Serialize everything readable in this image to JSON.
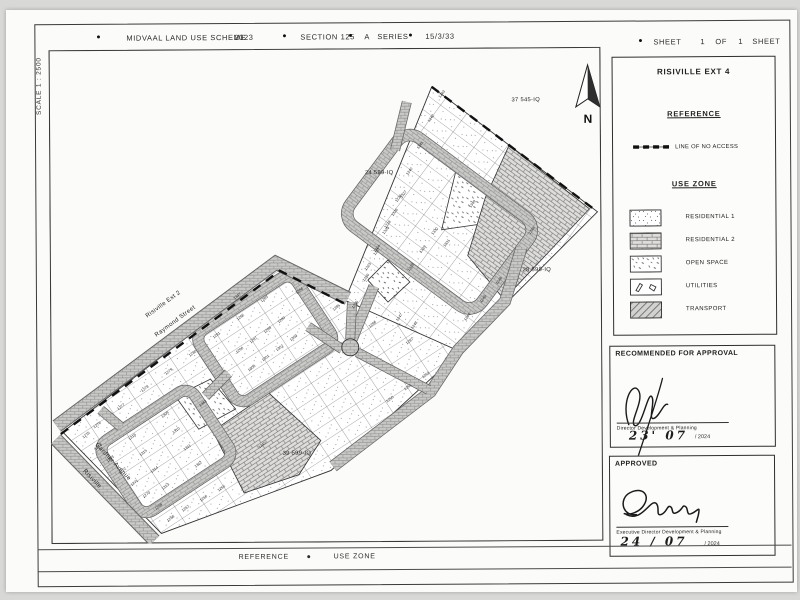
{
  "header": {
    "bullet": "●",
    "title": "MIDVAAL LAND USE SCHEME",
    "year": "2023",
    "section": "SECTION 125",
    "series_letter": "A",
    "series_word": "SERIES",
    "file_ref": "15/3/33",
    "sheet_word": "SHEET",
    "sheet_number": "1",
    "of_word": "OF",
    "sheet_total": "1",
    "sheet_word_2": "SHEET"
  },
  "scale_label": "SCALE 1 : 2500",
  "map": {
    "north_label": "N",
    "areas": {
      "north_west": "37 545-IQ",
      "west": "24 599-IQ",
      "east": "28 599-IQ",
      "south": "39 599-IQ"
    },
    "streets": {
      "adjacent_township": "Risiville Ext 2",
      "raymond": "Raymond Street",
      "gardner": "Gardner Avenue",
      "risiville": "Risiville"
    },
    "plots": [
      "1235",
      "1236",
      "1237",
      "1238",
      "1239",
      "1240",
      "1241",
      "1242",
      "1243",
      "1323",
      "1324",
      "1325",
      "1326",
      "1327",
      "1328",
      "1329",
      "1330",
      "1331",
      "1244",
      "1245",
      "1246",
      "1247",
      "1248",
      "1349",
      "1348",
      "1276",
      "1277",
      "1278",
      "1279",
      "1280",
      "1281",
      "1282",
      "1283",
      "1275",
      "1274",
      "1273",
      "1272",
      "1271",
      "1270",
      "1269",
      "1268",
      "1316",
      "1315",
      "1314",
      "1313",
      "1309",
      "1310",
      "1311",
      "1312",
      "1267",
      "1266",
      "1265",
      "1296",
      "1297",
      "1298",
      "1299",
      "1300",
      "1301",
      "1302",
      "1303",
      "1284",
      "1285",
      "1286",
      "1287",
      "1250",
      "1251",
      "1252",
      "1343",
      "1345",
      "1347"
    ]
  },
  "legend": {
    "township_title": "RISIVILLE EXT 4",
    "reference_heading": "REFERENCE",
    "no_access_label": "LINE OF NO ACCESS",
    "use_zone_heading": "USE ZONE",
    "zones": [
      {
        "label": "RESIDENTIAL 1"
      },
      {
        "label": "RESIDENTIAL 2"
      },
      {
        "label": "OPEN SPACE"
      },
      {
        "label": "UTILITIES"
      },
      {
        "label": "TRANSPORT"
      }
    ]
  },
  "approvals": {
    "recommended": {
      "title": "RECOMMENDED FOR APPROVAL",
      "signatory_role": "Director Development & Planning",
      "date_handwritten": "23' 07",
      "date_printed": "/ 2024"
    },
    "approved": {
      "title": "APPROVED",
      "signatory_role": "Executive Director Development & Planning",
      "date_handwritten": "24 / 07",
      "date_printed": "/ 2024"
    }
  },
  "footer": {
    "reference_label": "REFERENCE",
    "bullet": "●",
    "use_zone_label": "USE ZONE"
  }
}
